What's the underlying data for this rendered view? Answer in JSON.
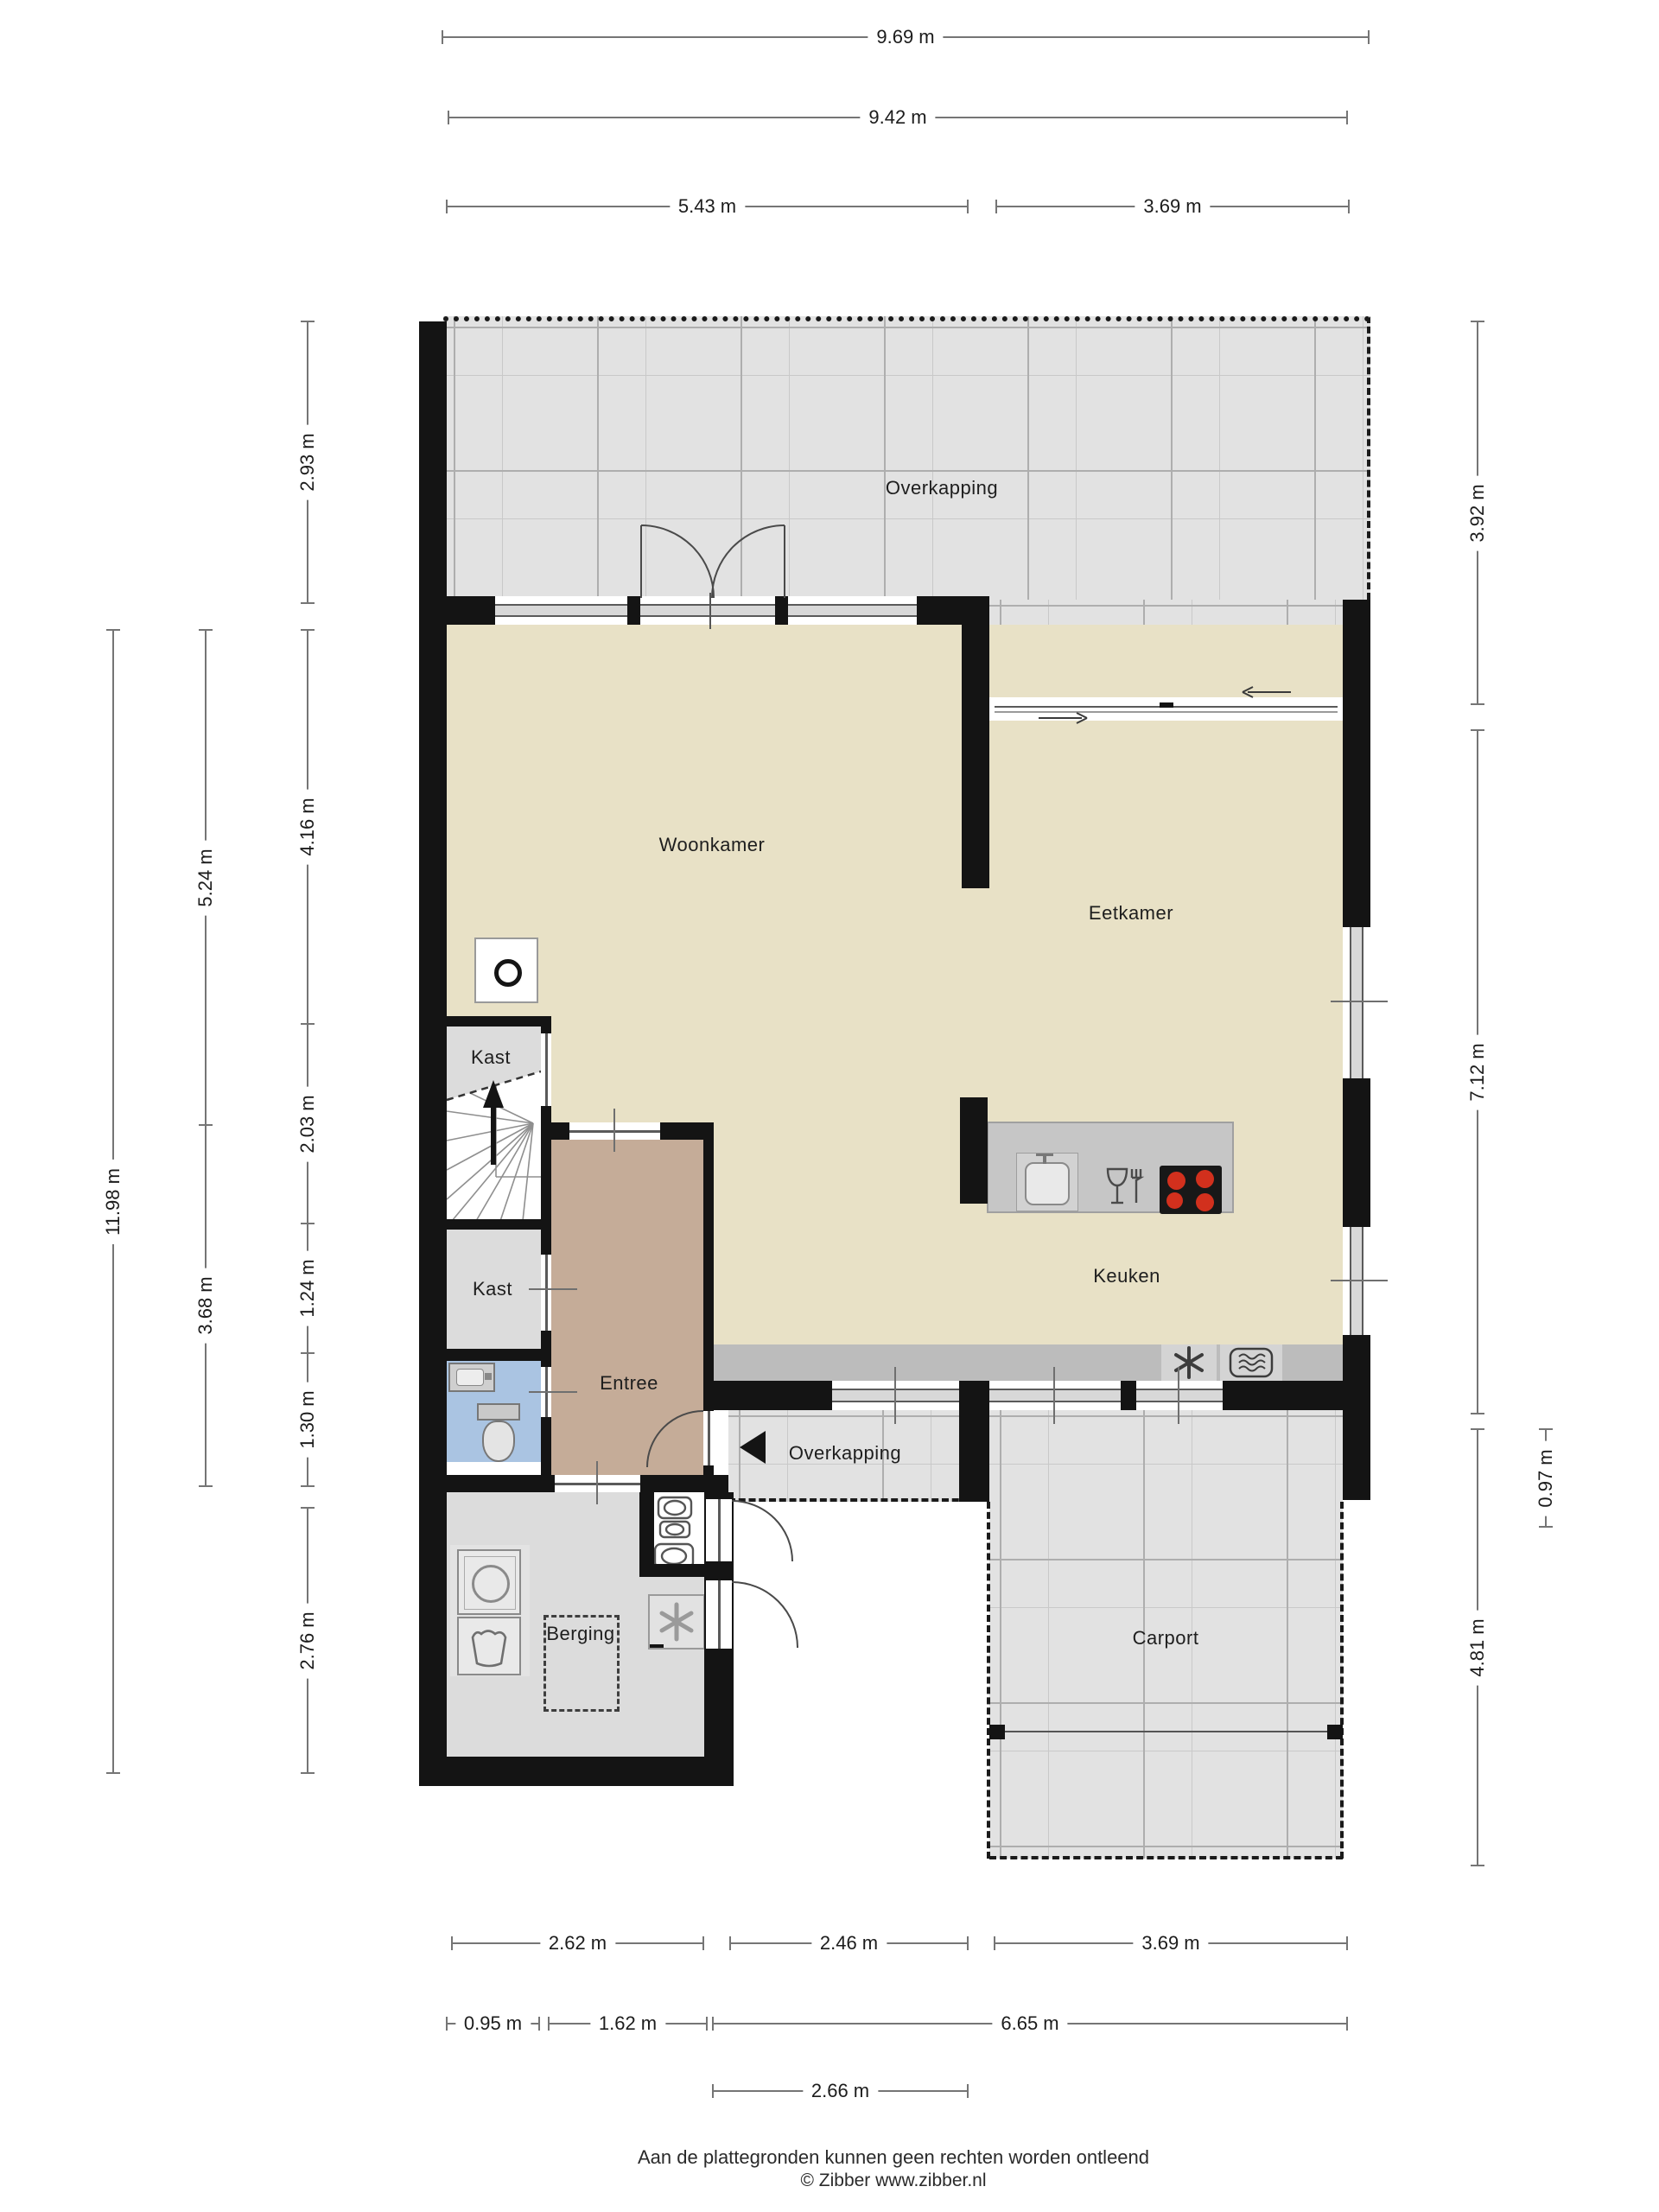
{
  "rooms": {
    "overkapping_top": "Overkapping",
    "woonkamer": "Woonkamer",
    "eetkamer": "Eetkamer",
    "keuken": "Keuken",
    "kast_boven": "Kast",
    "kast_onder": "Kast",
    "entree": "Entree",
    "overkapping_entree": "Overkapping",
    "berging": "Berging",
    "carport": "Carport"
  },
  "dims": {
    "top": [
      {
        "label": "9.69 m"
      },
      {
        "label": "9.42 m"
      },
      {
        "label": "5.43 m"
      },
      {
        "label": "3.69 m"
      }
    ],
    "left": [
      {
        "label": "11.98 m"
      },
      {
        "label": "5.24 m"
      },
      {
        "label": "3.68 m"
      },
      {
        "label": "2.93 m"
      },
      {
        "label": "4.16 m"
      },
      {
        "label": "2.03 m"
      },
      {
        "label": "1.24 m"
      },
      {
        "label": "1.30 m"
      },
      {
        "label": "2.76 m"
      }
    ],
    "right": [
      {
        "label": "3.92 m"
      },
      {
        "label": "7.12 m"
      },
      {
        "label": "4.81 m"
      },
      {
        "label": "0.97 m"
      }
    ],
    "bottom": [
      {
        "label": "2.62 m"
      },
      {
        "label": "2.46 m"
      },
      {
        "label": "3.69 m"
      },
      {
        "label": "0.95 m"
      },
      {
        "label": "1.62 m"
      },
      {
        "label": "6.65 m"
      },
      {
        "label": "2.66 m"
      }
    ]
  },
  "footer": {
    "disclaimer": "Aan de plattegronden kunnen geen rechten worden ontleend",
    "copyright": "© Zibber www.zibber.nl"
  },
  "colors": {
    "wall": "#141414",
    "floor_living": "#e8e1c6",
    "floor_entree": "#c5ac98",
    "floor_storage": "#dcdcdc",
    "floor_outdoor": "#e2e2e2",
    "toilet_floor": "#aac4e2",
    "counter": "#bcbcbc",
    "island": "#c6c6c6",
    "burner_red": "#d2301d",
    "dimension_line": "#757575"
  },
  "icons": {
    "stove": "circle-in-square",
    "stairs_up_arrow": "filled-up-arrow",
    "entrance_arrow": "filled-left-triangle",
    "washing_machine": "circle-drum-square",
    "laundry_basket": "wavy-basket-outline",
    "freezer_fan": "six-blade-star",
    "extractor_fan": "six-blade-star",
    "oven": "rounded-rect-waves",
    "cooktop": "four-red-burners",
    "kitchen_sink": "rounded-basin-with-tap",
    "dishwasher": "glass-and-fork",
    "toilet": "tank-and-bowl",
    "hand_basin": "small-basin",
    "meter_cabinet": "stacked-meters"
  }
}
